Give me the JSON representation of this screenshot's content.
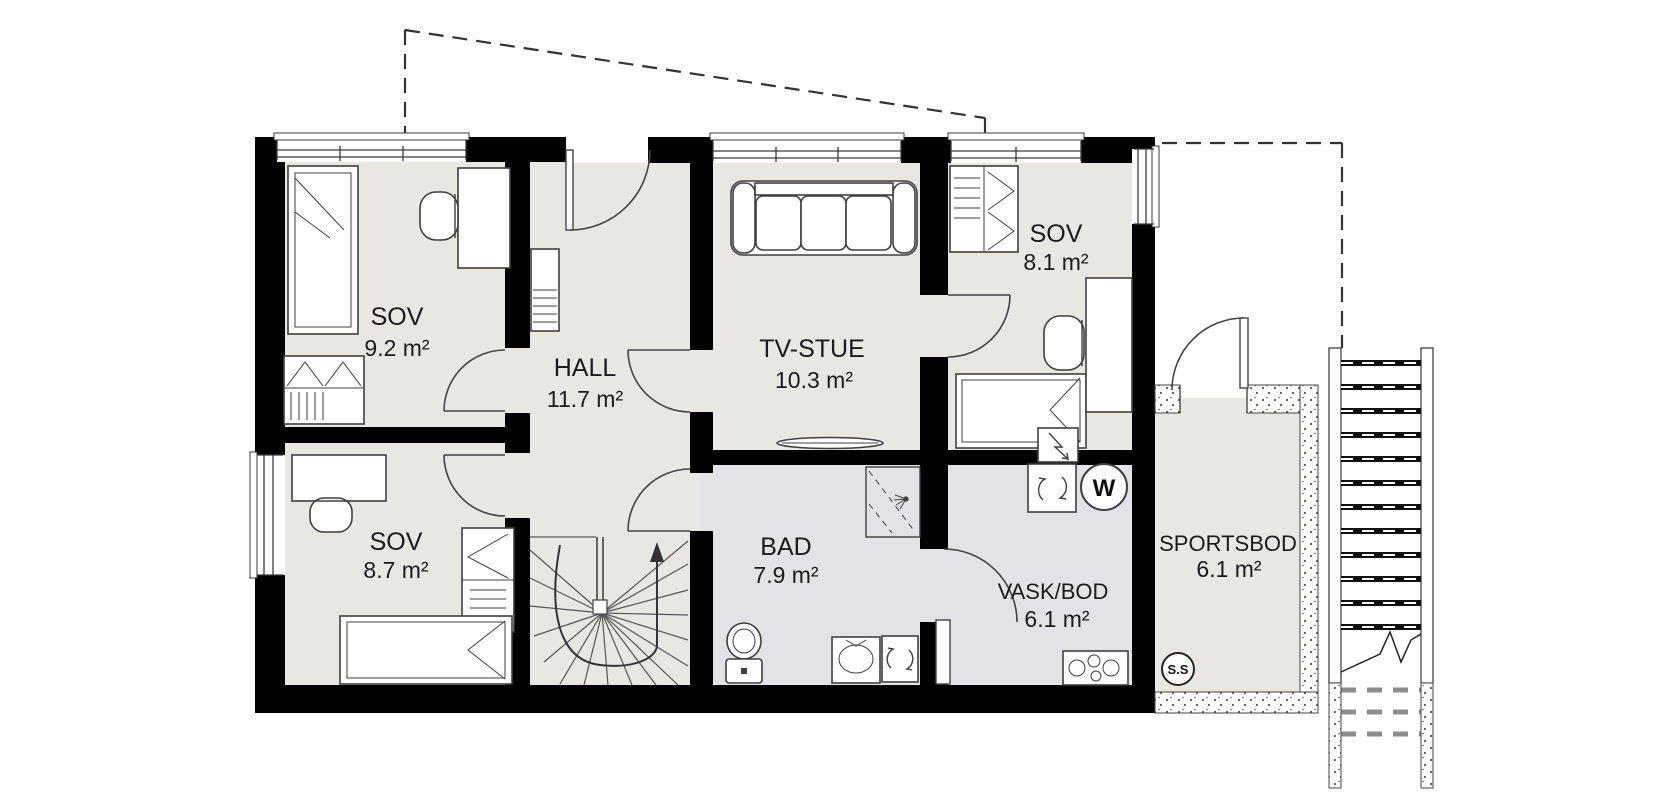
{
  "plan": {
    "rooms": [
      {
        "name": "SOV",
        "area": "9.2 m²"
      },
      {
        "name": "HALL",
        "area": "11.7 m²"
      },
      {
        "name": "TV-STUE",
        "area": "10.3 m²"
      },
      {
        "name": "SOV",
        "area": "8.1 m²"
      },
      {
        "name": "SOV",
        "area": "8.7 m²"
      },
      {
        "name": "BAD",
        "area": "7.9 m²"
      },
      {
        "name": "VASK/BOD",
        "area": "6.1 m²"
      },
      {
        "name": "SPORTSBOD",
        "area": "6.1 m²"
      }
    ],
    "symbols": {
      "dryer": "W",
      "ss_marker": "S.S"
    },
    "colors": {
      "wall": "#000000",
      "floor_main": "#e8e7e1",
      "floor_wet": "#e2e3e6",
      "line": "#3f3f3f",
      "background": "#ffffff"
    }
  }
}
